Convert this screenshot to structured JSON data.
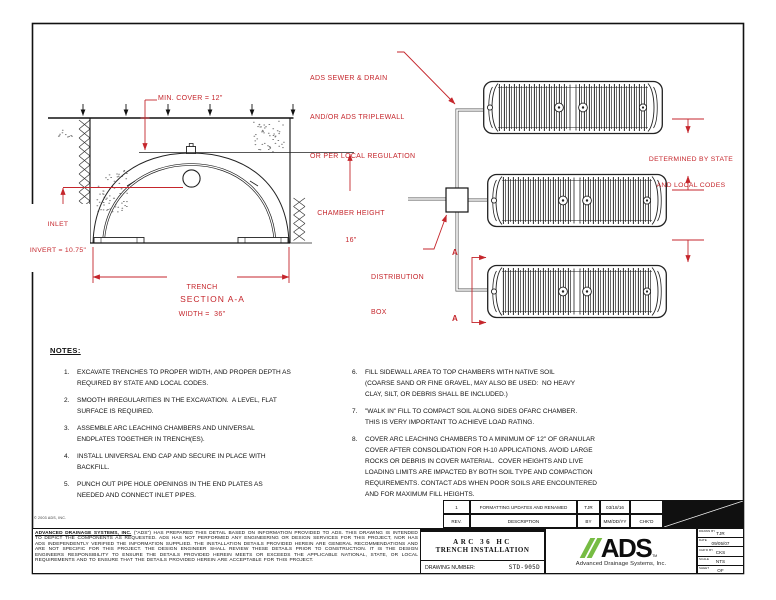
{
  "colors": {
    "red": "#c5262c",
    "green": "#76bc43",
    "line": "#111111"
  },
  "section_view": {
    "min_cover": "MIN. COVER = 12\"",
    "chamber_height_l1": "CHAMBER HEIGHT",
    "chamber_height_l2": "16\"",
    "inlet_l1": "INLET",
    "inlet_l2": "INVERT = 10.75\"",
    "trench_l1": "TRENCH",
    "trench_l2": "WIDTH =  36\"",
    "caption": "SECTION A-A"
  },
  "plan_view": {
    "pipe_note_l1": "ADS SEWER & DRAIN",
    "pipe_note_l2": "AND/OR ADS TRIPLEWALL",
    "pipe_note_l3": "OR PER LOCAL REGULATION",
    "dist_box_l1": "DISTRIBUTION",
    "dist_box_l2": "BOX",
    "determined_l1": "DETERMINED BY STATE",
    "determined_l2": "AND LOCAL CODES",
    "cut_label_top": "A",
    "cut_label_bottom": "A"
  },
  "notes": {
    "title": "NOTES:",
    "left": [
      {
        "num": "1.",
        "text": "EXCAVATE TRENCHES TO PROPER WIDTH, AND PROPER DEPTH AS\nREQUIRED BY STATE AND LOCAL CODES."
      },
      {
        "num": "2.",
        "text": "SMOOTH IRREGULARITIES IN THE EXCAVATION.  A LEVEL, FLAT\nSURFACE IS REQUIRED."
      },
      {
        "num": "3.",
        "text": "ASSEMBLE ARC LEACHING CHAMBERS AND UNIVERSAL\nENDPLATES TOGETHER IN TRENCH(ES)."
      },
      {
        "num": "4.",
        "text": "INSTALL UNIVERSAL END CAP AND SECURE IN PLACE WITH\nBACKFILL."
      },
      {
        "num": "5.",
        "text": "PUNCH OUT PIPE HOLE OPENINGS IN THE END PLATES AS\nNEEDED AND CONNECT INLET PIPES."
      }
    ],
    "right": [
      {
        "num": "6.",
        "text": "FILL SIDEWALL AREA TO TOP CHAMBERS WITH NATIVE SOIL\n(COARSE SAND OR FINE GRAVEL, MAY ALSO BE USED:  NO HEAVY\nCLAY, SILT, OR DEBRIS SHALL BE INCLUDED.)"
      },
      {
        "num": "7.",
        "text": "\"WALK IN\" FILL TO COMPACT SOIL ALONG SIDES OFARC CHAMBER.\nTHIS IS VERY IMPORTANT TO ACHIEVE LOAD RATING."
      },
      {
        "num": "8.",
        "text": "COVER ARC LEACHING CHAMBERS TO A MINIMUM OF 12\" OF GRANULAR\nCOVER AFTER CONSOLIDATION FOR H-10 APPLICATIONS. AVOID LARGE\nROCKS OR DEBRIS IN COVER MATERIAL.  COVER HEIGHTS AND LIVE\nLOADING LIMITS ARE IMPACTED BY BOTH SOIL TYPE AND COMPACTION\nREQUIREMENTS. CONTACT ADS WHEN POOR SOILS ARE ENCOUNTERED\nAND FOR MAXIMUM FILL HEIGHTS."
      }
    ]
  },
  "revisions": {
    "r1": [
      "1",
      "FORMATTING UPDATES AND RENAMED",
      "TJR",
      "03/18/16",
      ""
    ],
    "headers": [
      "REV.",
      "DESCRIPTION",
      "BY",
      "MM/DD/YY",
      "CHK'D"
    ]
  },
  "title_block": {
    "disclaimer_lead": "ADVANCED DRAINAGE SYSTEMS, INC.",
    "disclaimer_rest": " (\"ADS\") HAS PREPARED THIS DETAIL BASED ON INFORMATION PROVIDED TO ADS. THIS DRAWING IS INTENDED TO DEPICT THE COMPONENTS AS REQUESTED.  ADS HAS NOT PERFORMED ANY ENGINEERING OR DESIGN SERVICES FOR THIS PROJECT, NOR HAS ADS INDEPENDENTLY VERIFIED THE INFORMATION SUPPLIED.  THE INSTALLATION DETAILS PROVIDED HEREIN ARE GENERAL RECOMMENDATIONS AND ARE NOT SPECIFIC FOR THIS PROJECT.  THE DESIGN ENGINEER SHALL REVIEW THESE DETAILS PRIOR TO CONSTRUCTION.  IT IS THE DESIGN ENGINEERS RESPONSIBILITY TO ENSURE THE DETAILS PROVIDED HEREIN MEETS OR EXCEEDS THE APPLICABLE NATIONAL, STATE, OR LOCAL REQUIREMENTS AND TO ENSURE THAT THE DETAILS PROVIDED HEREIN ARE ACCEPTABLE FOR THIS PROJECT.",
    "title_l1": "ARC 36 HC",
    "title_l2": "TRENCH INSTALLATION",
    "drawing_number_label": "DRAWING NUMBER:",
    "drawing_number": "STD-905D",
    "logo_text": "ADS",
    "logo_tm": "TM",
    "logo_tagline": "Advanced Drainage Systems, Inc.",
    "fields": [
      {
        "label": "DRAWN BY",
        "value": "TJR"
      },
      {
        "label": "DATE",
        "value": "09/05/07"
      },
      {
        "label": "CHK'D BY",
        "value": "CKS"
      },
      {
        "label": "SCALE",
        "value": "NTS"
      },
      {
        "label": "SHEET",
        "value": "OF"
      }
    ]
  },
  "page": {
    "copyright": "© 2003 ADS, INC."
  }
}
